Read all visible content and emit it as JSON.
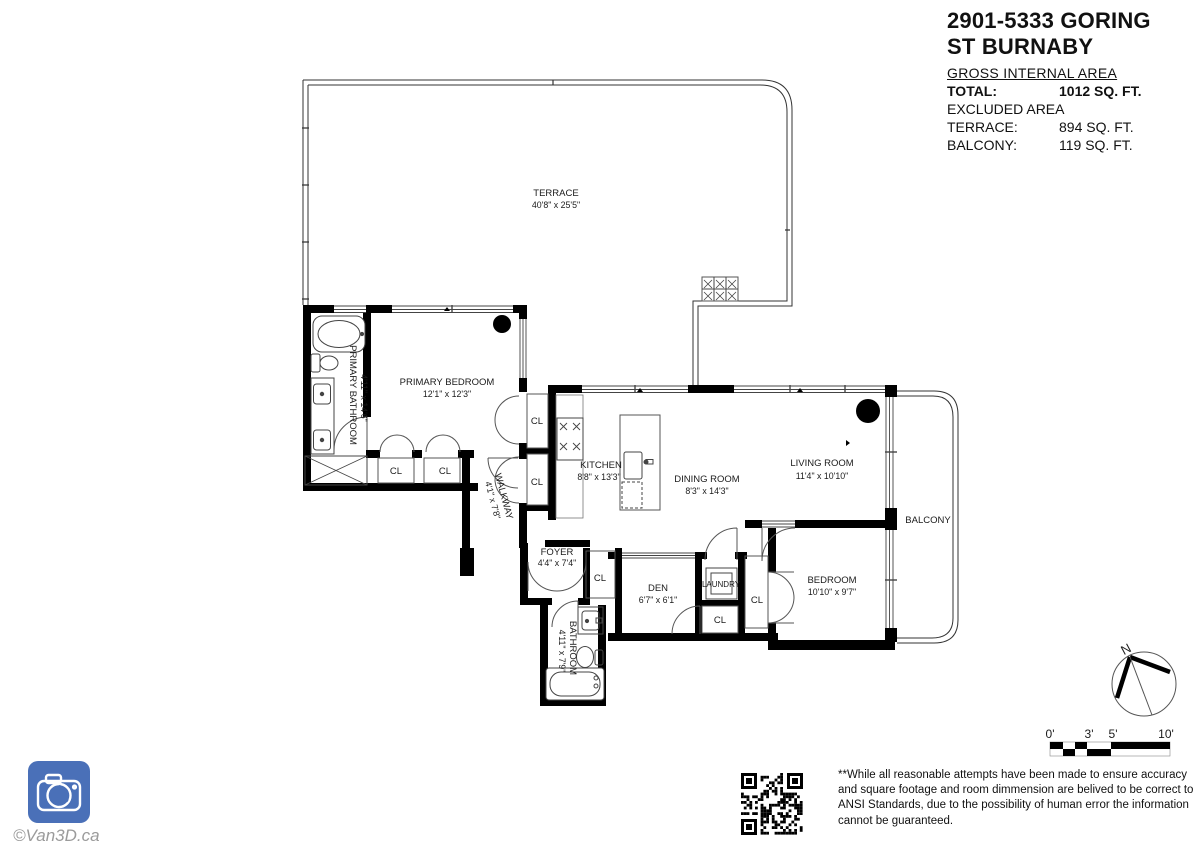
{
  "title_block": {
    "title_line1": "2901-5333 GORING",
    "title_line2": "ST BURNABY",
    "gross_label": "GROSS INTERNAL AREA",
    "total_label": "TOTAL:",
    "total_value": "1012 SQ. FT.",
    "excluded_label": "EXCLUDED AREA",
    "terrace_label": "TERRACE:",
    "terrace_value": "894 SQ. FT.",
    "balcony_label": "BALCONY:",
    "balcony_value": "119 SQ. FT."
  },
  "rooms": {
    "terrace": {
      "name": "TERRACE",
      "dims": "40'8\" x 25'5\""
    },
    "primary_bedroom": {
      "name": "PRIMARY BEDROOM",
      "dims": "12'1\" x 12'3\""
    },
    "primary_bathroom": {
      "name": "PRIMARY BATHROOM",
      "dims": "4'11\" x 14'6\""
    },
    "walkway": {
      "name": "WALKWAY",
      "dims": "4'1\" x 7'8\""
    },
    "kitchen": {
      "name": "KITCHEN",
      "dims": "8'8\" x 13'3\""
    },
    "dining_room": {
      "name": "DINING ROOM",
      "dims": "8'3\" x 14'3\""
    },
    "living_room": {
      "name": "LIVING ROOM",
      "dims": "11'4\" x 10'10\""
    },
    "balcony": {
      "name": "BALCONY"
    },
    "foyer": {
      "name": "FOYER",
      "dims": "4'4\" x 7'4\""
    },
    "den": {
      "name": "DEN",
      "dims": "6'7\" x 6'1\""
    },
    "laundry": {
      "name": "LAUNDRY"
    },
    "bedroom": {
      "name": "BEDROOM",
      "dims": "10'10\" x 9'7\""
    },
    "bathroom": {
      "name": "BATHROOM",
      "dims": "4'11\" x 7'9\""
    }
  },
  "labels": {
    "closet": "CL"
  },
  "compass": {
    "north": "N"
  },
  "scale_bar": {
    "ticks": [
      "0'",
      "3'",
      "5'",
      "10'"
    ]
  },
  "branding": {
    "watermark": "©Van3D.ca",
    "logo_color": "#4a70b8"
  },
  "footnote": {
    "text": "**While all reasonable attempts have been made to ensure accuracy and square footage and room dimmension are belived to be correct to ANSI Standards, due to the possibility of human error the information cannot be guaranteed."
  }
}
